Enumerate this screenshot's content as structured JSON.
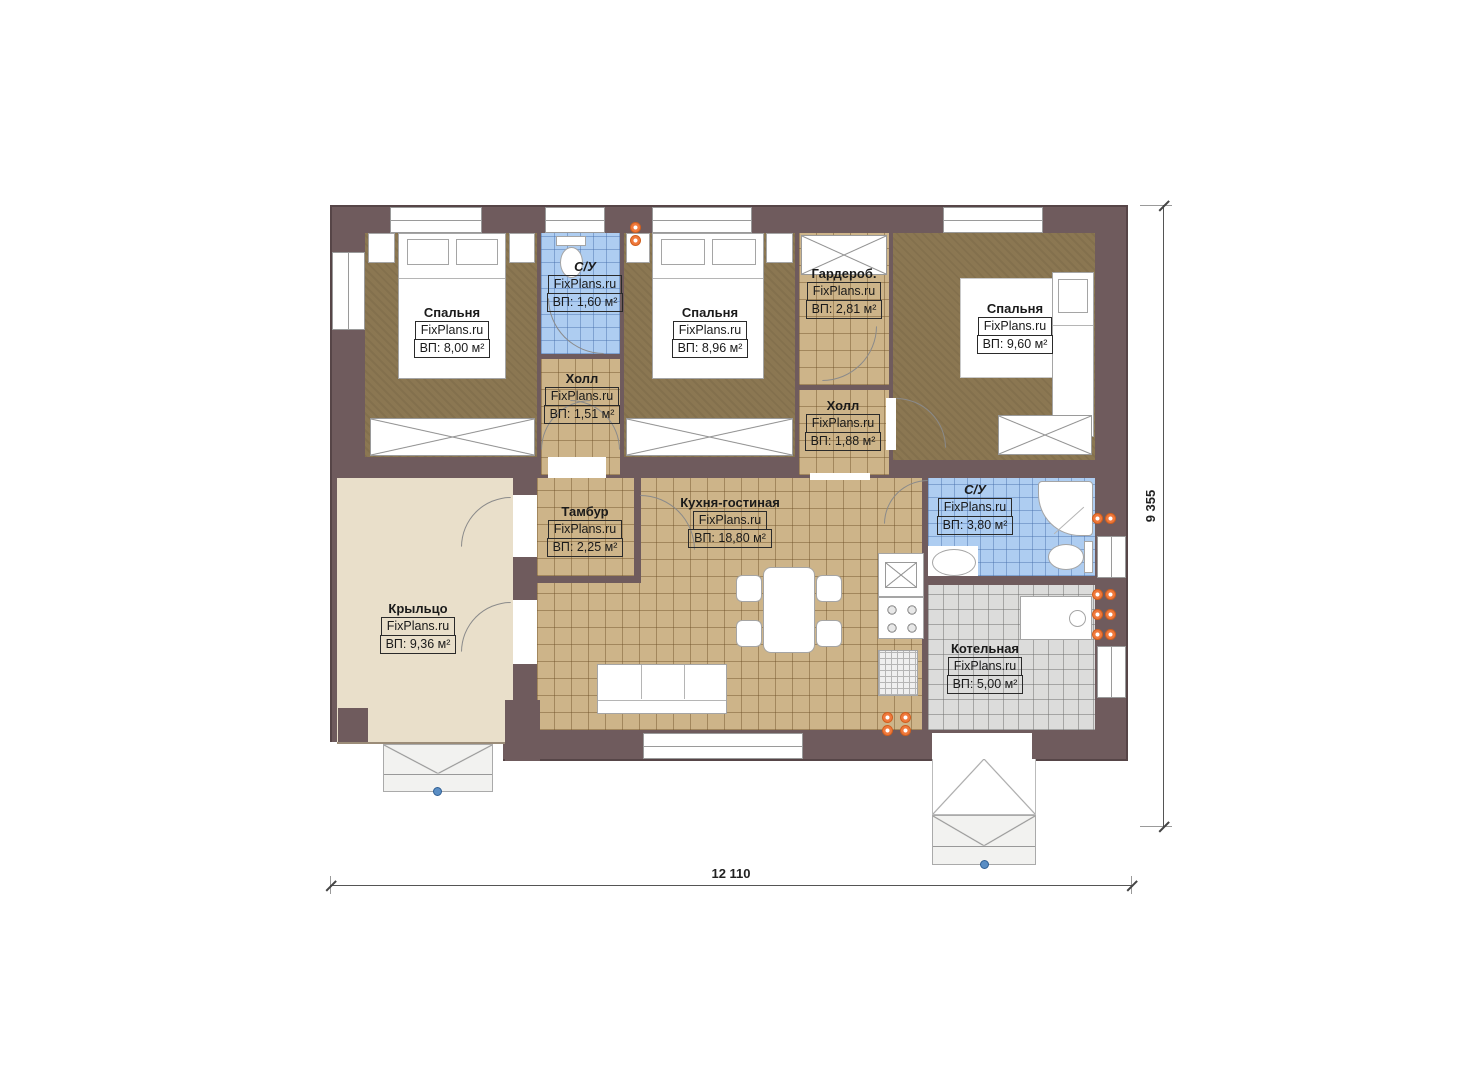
{
  "watermark": "FixPlans.ru",
  "dimensions": {
    "width_label": "12 110",
    "height_label": "9 355"
  },
  "colors": {
    "wall": "#6f5b5d",
    "bedroom_floor": "#8b7752",
    "tile_floor": "#cdb489",
    "bathroom_tile": "#aecdf1",
    "boiler_tile": "#dcdcdb",
    "porch_floor": "#e9dfca",
    "flue_marker": "#f0793c"
  },
  "rooms": [
    {
      "id": "bedroom-1",
      "name": "Спальня",
      "area": "ВП: 8,00 м²"
    },
    {
      "id": "bathroom-1",
      "name": "С/У",
      "area": "ВП: 1,60 м²"
    },
    {
      "id": "bedroom-2",
      "name": "Спальня",
      "area": "ВП: 8,96 м²"
    },
    {
      "id": "wardrobe",
      "name": "Гардероб.",
      "area": "ВП: 2,81 м²"
    },
    {
      "id": "bedroom-3",
      "name": "Спальня",
      "area": "ВП: 9,60 м²"
    },
    {
      "id": "hall-1",
      "name": "Холл",
      "area": "ВП: 1,51 м²"
    },
    {
      "id": "hall-2",
      "name": "Холл",
      "area": "ВП: 1,88 м²"
    },
    {
      "id": "vestibule",
      "name": "Тамбур",
      "area": "ВП: 2,25 м²"
    },
    {
      "id": "kitchen-living",
      "name": "Кухня-гостиная",
      "area": "ВП: 18,80 м²"
    },
    {
      "id": "bathroom-2",
      "name": "С/У",
      "area": "ВП: 3,80 м²"
    },
    {
      "id": "porch",
      "name": "Крыльцо",
      "area": "ВП: 9,36 м²"
    },
    {
      "id": "boiler-room",
      "name": "Котельная",
      "area": "ВП: 5,00 м²"
    }
  ]
}
